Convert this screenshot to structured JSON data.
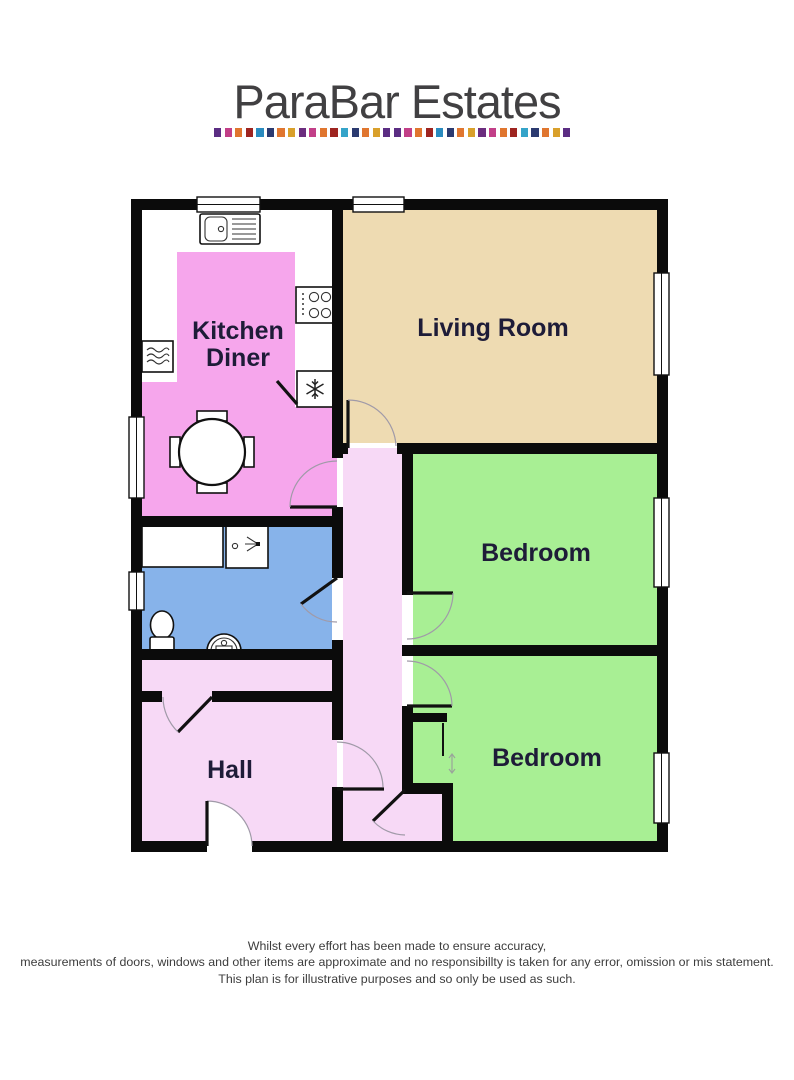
{
  "logo": {
    "title": "ParaBar Estates",
    "title_color": "#414042",
    "dash_count": 34,
    "dash_colors": [
      "#5b2d83",
      "#c23f88",
      "#e0762f",
      "#9e2420",
      "#2a8bbf",
      "#2b3a70",
      "#e0762f",
      "#d9a02b",
      "#6b2d7e",
      "#c23f88",
      "#e0762f",
      "#9e2420",
      "#35a4c9",
      "#2b3a70",
      "#e0762f",
      "#d9a02b",
      "#5b2d83"
    ]
  },
  "floor_plan": {
    "room_colors": {
      "kitchen": "#f6a6ec",
      "living": "#eedbb2",
      "bedroom": "#a8ef94",
      "hall": "#f7d9f6",
      "bathroom": "#87b3ea",
      "wall": "#0b0b0b"
    },
    "label_color": "#1e1c38",
    "labels": {
      "kitchen_line1": "Kitchen",
      "kitchen_line2": "Diner",
      "living": "Living Room",
      "bedroom1": "Bedroom",
      "bedroom2": "Bedroom",
      "hall": "Hall"
    }
  },
  "footer": {
    "line1": "Whilst every effort has been made to ensure accuracy,",
    "line2": "measurements of doors, windows and other items are approximate and no responsibillty is taken for any error, omission or mis statement.",
    "line3": "This plan is for illustrative purposes and so only be used as such."
  }
}
